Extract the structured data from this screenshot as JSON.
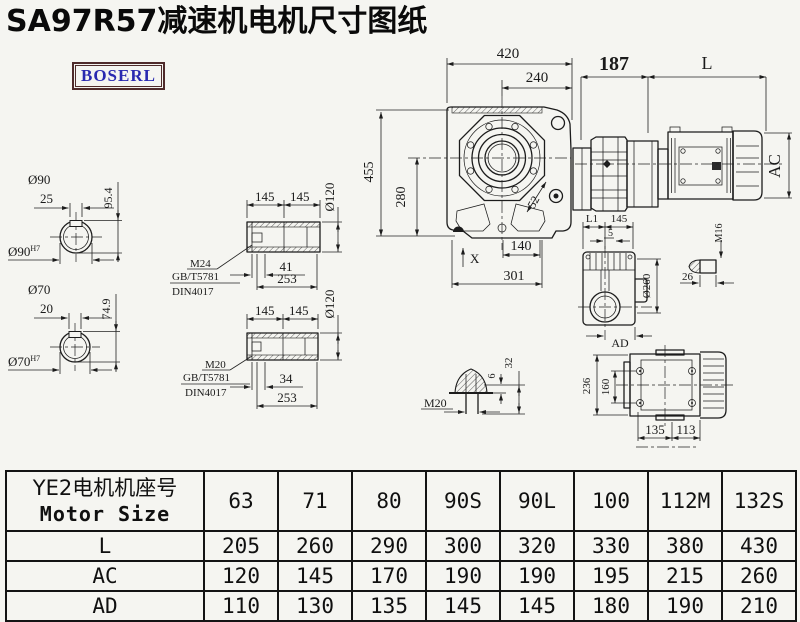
{
  "title": "SA97R57减速机电机尺寸图纸",
  "logo": {
    "text": "BOSERL"
  },
  "colors": {
    "background": "#f5f5f1",
    "line": "#1c1c1c",
    "logo_border": "#4f2b2b",
    "logo_text": "#2a2ab0"
  },
  "drawing": {
    "shaft_top": {
      "dia": "Ø90",
      "key_width": "25",
      "key_height": "95.4",
      "bore": "Ø90",
      "bore_fit": "H7"
    },
    "shaft_bottom": {
      "dia": "Ø70",
      "key_width": "20",
      "key_height": "74.9",
      "bore": "Ø70",
      "bore_fit": "H7"
    },
    "sleeve_top": {
      "len_a": "145",
      "len_b": "145",
      "dia": "Ø120",
      "thread": "M24",
      "std1": "GB/T5781",
      "std2": "DIN4017",
      "depth": "41",
      "total": "253"
    },
    "sleeve_bottom": {
      "len_a": "145",
      "len_b": "145",
      "dia": "Ø120",
      "thread": "M20",
      "std1": "GB/T5781",
      "std2": "DIN4017",
      "depth": "34",
      "total": "253"
    },
    "front_view": {
      "width": "420",
      "width_inner": "240",
      "adapter_len": "187",
      "motor_len": "L",
      "height": "455",
      "height_inner": "280",
      "flange": "52",
      "foot": "X",
      "bottom_inner": "140",
      "bottom": "301",
      "motor_dia": "AC"
    },
    "side_view": {
      "l1": "L1",
      "len": "145",
      "gap": "5",
      "boss_dia": "Ø260",
      "ad": "AD",
      "plug_thread": "M16",
      "plug_len": "26"
    },
    "bolt_detail": {
      "thread": "M20",
      "head_h": "6",
      "len": "32"
    },
    "rear_view": {
      "height": "236",
      "bolt_pitch": "160",
      "foot_a": "135",
      "foot_b": "113"
    }
  },
  "table": {
    "header": {
      "title_cn": "YE2电机机座号",
      "title_en": "Motor Size",
      "sizes": [
        "63",
        "71",
        "80",
        "90S",
        "90L",
        "100",
        "112M",
        "132S"
      ]
    },
    "rows": [
      {
        "label": "L",
        "values": [
          "205",
          "260",
          "290",
          "300",
          "320",
          "330",
          "380",
          "430"
        ]
      },
      {
        "label": "AC",
        "values": [
          "120",
          "145",
          "170",
          "190",
          "190",
          "195",
          "215",
          "260"
        ]
      },
      {
        "label": "AD",
        "values": [
          "110",
          "130",
          "135",
          "145",
          "145",
          "180",
          "190",
          "210"
        ]
      }
    ]
  }
}
